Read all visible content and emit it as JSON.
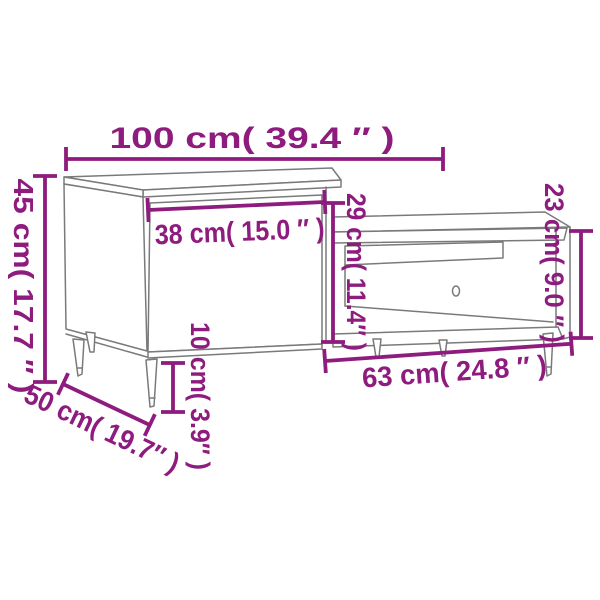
{
  "image": {
    "type": "product-dimension-diagram",
    "subject": "two-piece coffee table set: left cabinet with door and lower nesting table with open shelf, tapered legs"
  },
  "measurements": {
    "total_width": {
      "cm": "100",
      "in": "39.4",
      "label": "100 cm( 39.4 ″ )"
    },
    "left_height": {
      "cm": "45",
      "in": "17.7",
      "label": "45 cm( 17.7 ″ )"
    },
    "door_width": {
      "cm": "38",
      "in": "15.0",
      "label": "38 cm( 15.0 ″ )"
    },
    "middle_height": {
      "cm": "29",
      "in": "11.4",
      "label": "29 cm( 11.4″ )"
    },
    "right_height": {
      "cm": "23",
      "in": "9.0",
      "label": "23 cm( 9.0 ″ )"
    },
    "leg_height": {
      "cm": "10",
      "in": "3.9",
      "label": "10 cm( 3.9″ )"
    },
    "right_width": {
      "cm": "63",
      "in": "24.8",
      "label": "63 cm( 24.8 ″ )"
    },
    "depth": {
      "cm": "50",
      "in": "19.7",
      "label": "50 cm( 19.7″ )"
    }
  },
  "colors": {
    "dimension": "#8e1b7e",
    "artwork": "#7a7a7a",
    "background": "#ffffff"
  }
}
